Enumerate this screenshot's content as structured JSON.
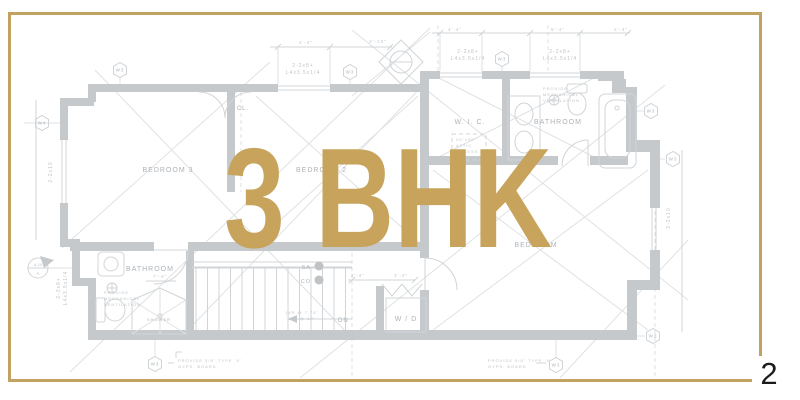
{
  "slide": {
    "page_number": "2"
  },
  "overlay": {
    "title": "3 BHK"
  },
  "colors": {
    "frame_gold": "#C2A261",
    "title_gold": "#C7A35C",
    "wall_gray": "#c6c9cc",
    "line_gray": "#d0d4d7",
    "faint_gray": "#dfe1e3",
    "plan_text_gray": "#aeb3b7",
    "tiny_text_gray": "#c0c4c7",
    "page_number_color": "#1c1c1c"
  },
  "floorplan": {
    "room_labels": [
      {
        "text": "BEDROOM 3",
        "x": 168,
        "y": 172,
        "fs": 7,
        "anchor": "middle"
      },
      {
        "text": "BEDROOM 2",
        "x": 296,
        "y": 172,
        "fs": 7,
        "anchor": "start"
      },
      {
        "text": "W. I. C.",
        "x": 470,
        "y": 124,
        "fs": 7,
        "anchor": "middle"
      },
      {
        "text": "BATHROOM",
        "x": 558,
        "y": 124,
        "fs": 7,
        "anchor": "middle"
      },
      {
        "text": "BEDROOM",
        "x": 536,
        "y": 247,
        "fs": 7,
        "anchor": "middle"
      },
      {
        "text": "BATHROOM",
        "x": 150,
        "y": 271,
        "fs": 7,
        "anchor": "middle"
      },
      {
        "text": "CL.",
        "x": 243,
        "y": 110,
        "fs": 6,
        "anchor": "middle"
      },
      {
        "text": "W / D",
        "x": 406,
        "y": 321,
        "fs": 7,
        "anchor": "middle"
      },
      {
        "text": "SHOWER",
        "x": 159,
        "y": 321,
        "fs": 4,
        "anchor": "middle"
      }
    ],
    "notes": [
      {
        "lines": [
          "PROVIDE",
          "MECHANICAL",
          "VENTILATION"
        ],
        "x": 543,
        "y": 90,
        "fs": 4
      },
      {
        "lines": [
          "PROVIDE",
          "MECHANICAL",
          "VENTILATION"
        ],
        "x": 104,
        "y": 294,
        "fs": 4
      },
      {
        "lines": [
          "20\"x30\"",
          "ATTIC",
          "ACCESS"
        ],
        "x": 456,
        "y": 141,
        "fs": 4
      },
      {
        "lines": [
          "PROVIDE 5/8\" TYPE 'X'",
          "GYPS. BOARD"
        ],
        "x": 178,
        "y": 362,
        "fs": 4
      },
      {
        "lines": [
          "PROVIDE 5/8\" TYPE 'X'",
          "GYPS. BOARD"
        ],
        "x": 488,
        "y": 362,
        "fs": 4
      }
    ],
    "beam_labels": [
      {
        "lines": [
          "2-2x8+",
          "L4x3.5x1/4"
        ],
        "x": 303,
        "y": 67,
        "fs": 5,
        "rot": 0
      },
      {
        "lines": [
          "2-2x8+",
          "L4x3.5x1/4"
        ],
        "x": 468,
        "y": 53,
        "fs": 5,
        "rot": 0
      },
      {
        "lines": [
          "2-2x8+",
          "L4x3.5x1/4"
        ],
        "x": 560,
        "y": 53,
        "fs": 5,
        "rot": 0
      },
      {
        "lines": [
          "2-2x8+",
          "L4x3.5x1/4"
        ],
        "x": 60,
        "y": 288,
        "fs": 5,
        "rot": -90
      }
    ],
    "size_labels": [
      {
        "text": "4'-4\"",
        "x": 306,
        "y": 44,
        "fs": 4.5,
        "rot": 0
      },
      {
        "text": "2'-10\"",
        "x": 378,
        "y": 43,
        "fs": 4.5,
        "rot": 0
      },
      {
        "text": "4'-4\"",
        "x": 455,
        "y": 31,
        "fs": 4.5,
        "rot": 0
      },
      {
        "text": "5'-4\"",
        "x": 558,
        "y": 31,
        "fs": 4.5,
        "rot": 0
      },
      {
        "text": "2'-4\"",
        "x": 621,
        "y": 31,
        "fs": 4.5,
        "rot": 0
      },
      {
        "text": "2'-4\"",
        "x": 358,
        "y": 277,
        "fs": 4.5,
        "rot": 0
      },
      {
        "text": "3'-4\"",
        "x": 401,
        "y": 277,
        "fs": 4.5,
        "rot": 0
      },
      {
        "text": "7'-4\"",
        "x": 160,
        "y": 278,
        "fs": 4.5,
        "rot": 0
      },
      {
        "text": "3'-0\"",
        "x": 95,
        "y": 296,
        "fs": 4.5,
        "rot": -90
      },
      {
        "text": "2-2x10",
        "x": 52,
        "y": 172,
        "fs": 5,
        "rot": -90
      },
      {
        "text": "2-2x10",
        "x": 670,
        "y": 218,
        "fs": 5,
        "rot": -90
      }
    ],
    "markers": [
      {
        "text": "W3",
        "x": 120,
        "y": 70
      },
      {
        "text": "W3",
        "x": 350,
        "y": 72
      },
      {
        "text": "W3",
        "x": 502,
        "y": 59
      },
      {
        "text": "W4",
        "x": 42,
        "y": 123
      },
      {
        "text": "W3",
        "x": 651,
        "y": 111
      },
      {
        "text": "W3",
        "x": 673,
        "y": 159
      },
      {
        "text": "W3",
        "x": 155,
        "y": 364
      },
      {
        "text": "W3",
        "x": 556,
        "y": 365
      },
      {
        "text": "W3",
        "x": 653,
        "y": 336
      }
    ],
    "section_marker": {
      "top": "A-10",
      "bottom": "A"
    },
    "legend": [
      {
        "text": "SA",
        "x": 311,
        "y": 269,
        "dx": 319,
        "dy": 266
      },
      {
        "text": "CO",
        "x": 311,
        "y": 283,
        "dx": 319,
        "dy": 280
      }
    ],
    "stairs": {
      "dn": "DN",
      "dn_x": 338,
      "dn_y": 322,
      "note_lines": [
        "14R @ 7.75\"",
        "13T @ 10\""
      ],
      "note_x": 302,
      "note_y": 314
    }
  }
}
